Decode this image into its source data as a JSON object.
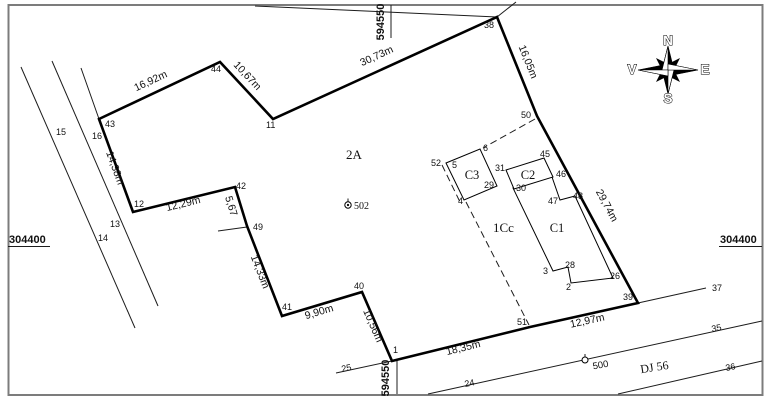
{
  "plan": {
    "region_label": "2A",
    "landuse_label": "1Cc",
    "marker_502": "502",
    "marker_500": "500",
    "road_name": "DJ 56"
  },
  "grid": {
    "top": "594550",
    "bottom": "594550",
    "left": "304400",
    "right": "304400"
  },
  "compass": {
    "n": "N",
    "s": "S",
    "e": "E",
    "v": "V"
  },
  "buildings": {
    "c1": "C1",
    "c2": "C2",
    "c3": "C3"
  },
  "points": {
    "1": "1",
    "2": "2",
    "3": "3",
    "4": "4",
    "5": "5",
    "6": "6",
    "11": "11",
    "12": "12",
    "13": "13",
    "14": "14",
    "15": "15",
    "16": "16",
    "24": "24",
    "25": "25",
    "26": "26",
    "28": "28",
    "29": "29",
    "30": "30",
    "31": "31",
    "35": "35",
    "36": "36",
    "37": "37",
    "38": "38",
    "39": "39",
    "40": "40",
    "41": "41",
    "42": "42",
    "43": "43",
    "44": "44",
    "45": "45",
    "46": "46",
    "47": "47",
    "48": "48",
    "49": "49",
    "50": "50",
    "51": "51",
    "52": "52"
  },
  "measurements": {
    "43-44": "16,92m",
    "44-11": "10,67m",
    "11-38": "30,73m",
    "38-50": "16,05m",
    "50-39": "29,74m",
    "39-51": "12,97m",
    "51-1": "18,35m",
    "1-40": "10,56m",
    "40-41": "9,90m",
    "41-49": "14,33m",
    "49-42": "5,67",
    "42-12": "12,29m",
    "12-43": "14,38m"
  }
}
